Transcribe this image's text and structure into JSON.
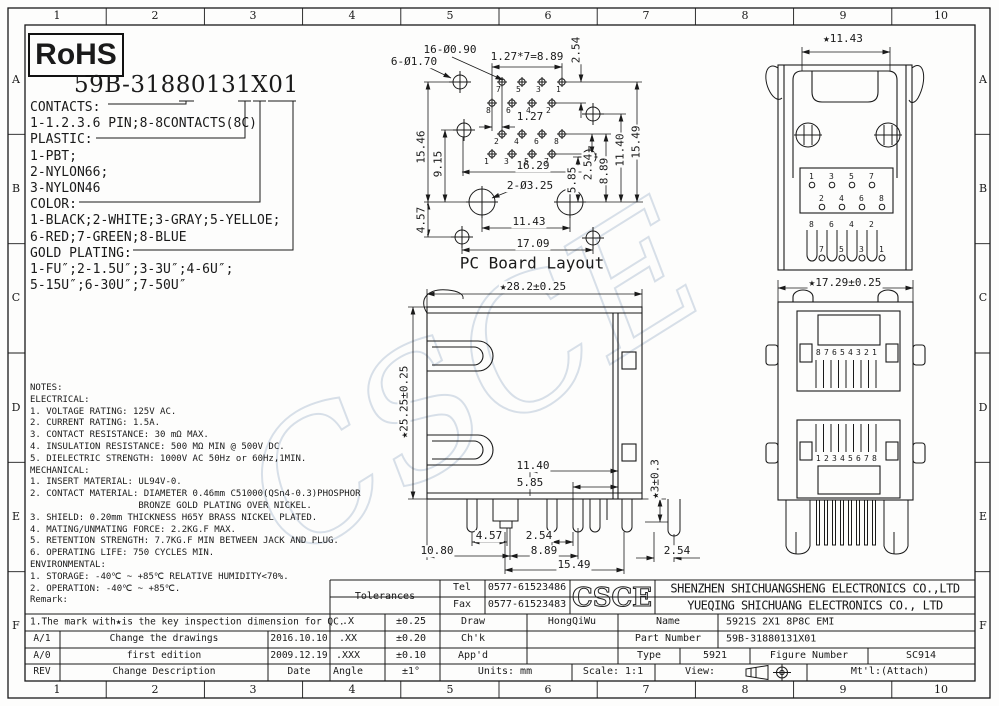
{
  "frame": {
    "cols": [
      "1",
      "2",
      "3",
      "4",
      "5",
      "6",
      "7",
      "8",
      "9",
      "10"
    ],
    "rows": [
      "A",
      "B",
      "C",
      "D",
      "E",
      "F"
    ]
  },
  "header": {
    "rohs": "RoHS",
    "part_number": "59B-31880131X01"
  },
  "legend": {
    "lines": "CONTACTS:\n1-1.2.3.6 PIN;8-8CONTACTS(8C)\nPLASTIC:\n1-PBT;\n2-NYLON66;\n3-NYLON46\nCOLOR:\n1-BLACK;2-WHITE;3-GRAY;5-YELLOE;\n6-RED;7-GREEN;8-BLUE\nGOLD PLATING:\n1-FU″;2-1.5U″;3-3U″;4-6U″;\n5-15U″;6-30U″;7-50U″"
  },
  "pcb": {
    "caption": "PC Board Layout",
    "labels": {
      "holes_small": "16-Ø0.90",
      "holes_big": "6-Ø1.70",
      "pitch": "1.27*7=8.89",
      "v254_top": "2.54",
      "h1546": "15.46",
      "h915": "9.15",
      "h457": "4.57",
      "d127": "1.27",
      "w1629": "16.29",
      "v585": "5.85",
      "v254": "2.54",
      "v889": "8.89",
      "v1140": "11.40",
      "v1549": "15.49",
      "holes_325": "2-Ø3.25",
      "w1143": "11.43",
      "w1709": "17.09"
    },
    "pins": {
      "g1r1": "7 5 3 1",
      "g1r2": "8 6 4 2",
      "g2r1": "2 4 6 8",
      "g2r2": "1 3 5 7"
    }
  },
  "side_view": {
    "dims": {
      "w": "★28.2±0.25",
      "h": "★25.25±0.25",
      "d1140": "11.40",
      "d585": "5.85",
      "d3": "★3±0.3",
      "d457": "4.57",
      "d254a": "2.54",
      "d1080": "10.80",
      "d889": "8.89",
      "d1549": "15.49",
      "d254b": "2.54"
    }
  },
  "top_view": {
    "dim_w": "★11.43",
    "pins_r1": "1 3 5 7",
    "pins_r2": "2 4 6 8",
    "leads_r1": "8 6 4 2",
    "leads_r2": "7 5 3 1"
  },
  "front_view": {
    "dim_w": "★17.29±0.25",
    "port1_pins": "87654321",
    "port2_pins": "12345678"
  },
  "watermark": "CSCE",
  "notes": {
    "text": "NOTES:\nELECTRICAL:\n1. VOLTAGE RATING: 125V AC.\n2. CURRENT RATING: 1.5A.\n3. CONTACT RESISTANCE: 30 mΩ MAX.\n4. INSULATION RESISTANCE: 500 MΩ MIN @ 500V DC.\n5. DIELECTRIC STRENGTH: 1000V AC 50Hz or 60Hz,1MIN.\nMECHANICAL:\n1. INSERT MATERIAL: UL94V-0.\n2. CONTACT MATERIAL: DIAMETER 0.46mm C51000(QSn4-0.3)PHOSPHOR\n                    BRONZE GOLD PLATING OVER NICKEL.\n3. SHIELD: 0.20mm THICKNESS H65Y BRASS NICKEL PLATED.\n4. MATING/UNMATING FORCE: 2.2KG.F MAX.\n5. RETENTION STRENGTH: 7.7KG.F MIN BETWEEN JACK AND PLUG.\n6. OPERATING LIFE: 750 CYCLES MIN.\nENVIRONMENTAL:\n1. STORAGE: -40℃ ~ +85℃ RELATIVE HUMIDITY<70%.\n2. OPERATION: -40℃ ~ +85℃.\nRemark:",
    "qc_mark": "1.The mark with★is the key inspection dimension for QC."
  },
  "revisions": {
    "rows": [
      {
        "rev": "A/1",
        "desc": "Change the drawings",
        "date": "2016.10.10"
      },
      {
        "rev": "A/0",
        "desc": "first edition",
        "date": "2009.12.19"
      },
      {
        "rev": "REV",
        "desc": "Change Description",
        "date": "Date"
      }
    ]
  },
  "titleblock": {
    "tolerances_label": "Tolerances",
    "tel_label": "Tel",
    "tel": "0577-61523486",
    "fax_label": "Fax",
    "fax": "0577-61523483",
    "logo": "CSCE",
    "company1": "SHENZHEN SHICHUANGSHENG ELECTRONICS CO.,LTD",
    "company2": "YUEQING SHICHUANG ELECTRONICS CO., LTD",
    "tol_rows": [
      {
        "k": ".X",
        "v": "±0.25"
      },
      {
        "k": ".XX",
        "v": "±0.20"
      },
      {
        "k": ".XXX",
        "v": "±0.10"
      }
    ],
    "angle_label": "Angle",
    "angle_tol": "±1°",
    "draw_label": "Draw",
    "draw_value": "HongQiWu",
    "chk_label": "Ch'k",
    "appd_label": "App'd",
    "name_label": "Name",
    "name_value": "5921S 2X1 8P8C EMI",
    "pn_label": "Part Number",
    "pn_value": "59B-31880131X01",
    "type_label": "Type",
    "type_value": "5921",
    "fig_label": "Figure Number",
    "fig_value": "SC914",
    "units_label": "Units: mm",
    "scale_label": "Scale: 1:1",
    "view_label": "View:",
    "mtl_label": "Mt'l:(Attach)"
  }
}
